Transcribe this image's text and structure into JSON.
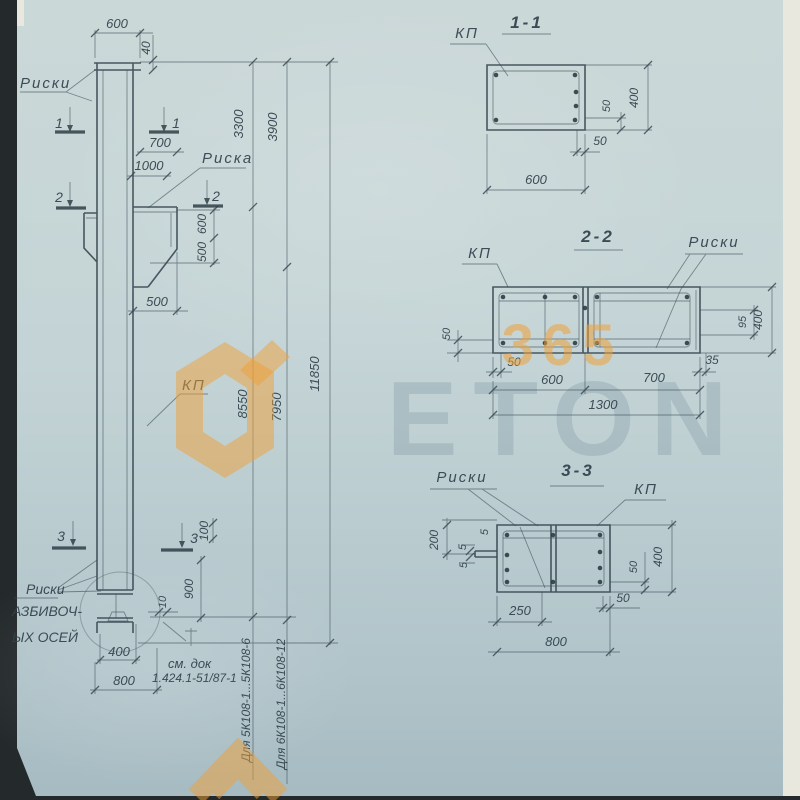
{
  "watermark": {
    "n365": "365",
    "eton": "ETON"
  },
  "el": {
    "riski": "Риски",
    "d600": "600",
    "d40": "40",
    "m1": "1",
    "d700": "700",
    "d1000": "1000",
    "riska": "Риска",
    "m2": "2",
    "d600v": "600",
    "d500v": "500",
    "d500h": "500",
    "d3300": "3300",
    "d3900": "3900",
    "kp": "КП",
    "d8550": "8550",
    "d7950": "7950",
    "d11850": "11850",
    "m3": "3",
    "d100": "100",
    "d900": "900",
    "d10": "10",
    "riski2": "Риски",
    "ax1": "АЗБИВОЧ-",
    "ax2": "ЫХ ОСЕЙ",
    "d400": "400",
    "d800": "800",
    "doc1": "см. док",
    "doc2": "1.424.1-51/87-1",
    "for5": "Для 5К108-1...5К108-6",
    "for6": "Для 6К108-1...6К108-12"
  },
  "s1": {
    "t": "1-1",
    "kp": "КП",
    "d50v": "50",
    "d50h": "50",
    "d400": "400",
    "d600": "600"
  },
  "s2": {
    "t": "2-2",
    "kp": "КП",
    "riski": "Риски",
    "d50l": "50",
    "d50b": "50",
    "d600": "600",
    "d700": "700",
    "d1300": "1300",
    "d35": "35",
    "d95": "95",
    "d400": "400"
  },
  "s3": {
    "t": "3-3",
    "riski": "Риски",
    "kp": "КП",
    "d200": "200",
    "d5": "5",
    "d250": "250",
    "d800": "800",
    "d50r": "50",
    "d50b": "50",
    "d400": "400"
  }
}
